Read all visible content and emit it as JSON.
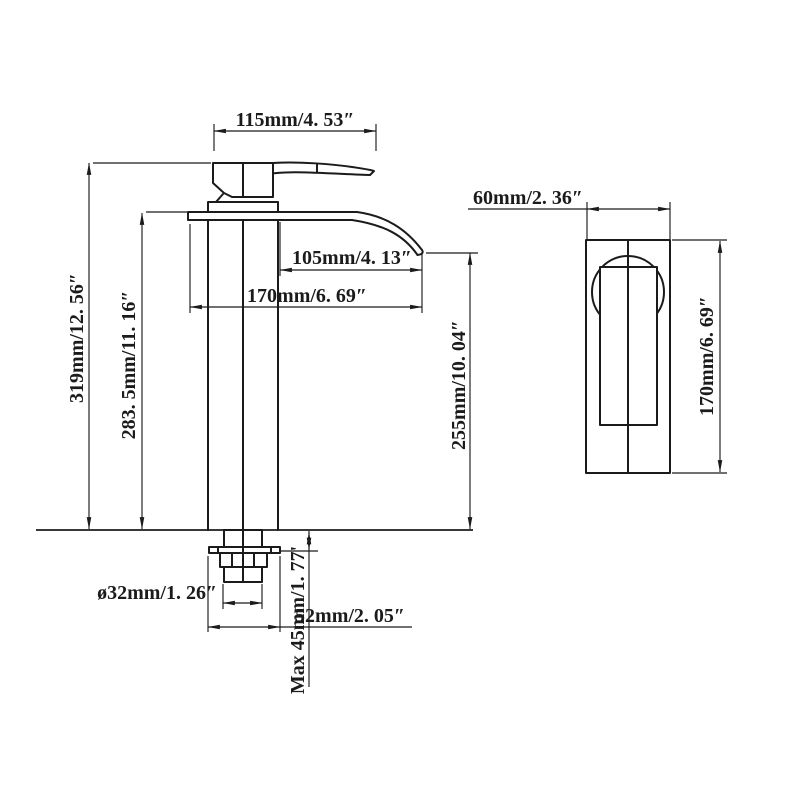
{
  "drawing": {
    "type": "faucet-technical-dimension-drawing",
    "ink_color": "#1b1b1b",
    "background_color": "#ffffff"
  },
  "dims": {
    "top_width": "115mm/4. 53″",
    "spout_reach": "105mm/4. 13″",
    "spout_length": "170mm/6. 69″",
    "overall_height": "319mm/12. 56″",
    "body_height": "283. 5mm/11. 16″",
    "spout_tip_height": "255mm/10. 04″",
    "thread_diameter": "ø32mm/1. 26″",
    "base_width": "52mm/2. 05″",
    "max_deck_thickness": "Max 45mm/1. 77'",
    "side_width": "60mm/2. 36″",
    "side_height": "170mm/6. 69″"
  }
}
